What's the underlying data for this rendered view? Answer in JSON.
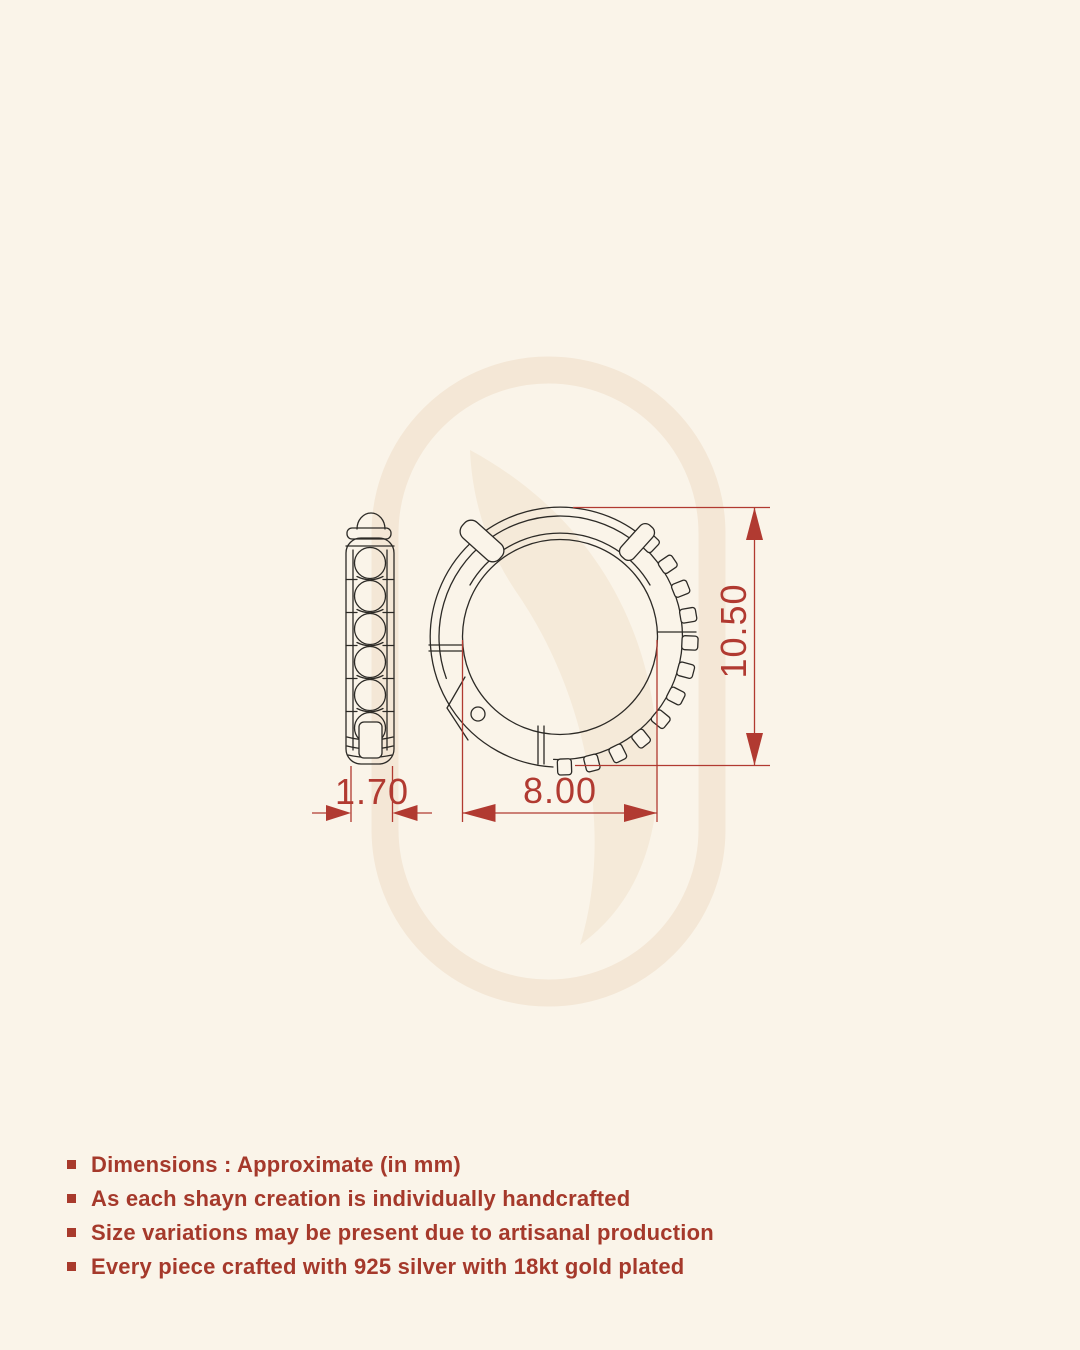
{
  "meta": {
    "description": "Jewellery technical dimension drawing of a huggie hoop earring (side profile and front view) with measurements, over a cream background with brand watermark"
  },
  "colors": {
    "background": "#faf4e9",
    "accent_red": "#b13a31",
    "note_text_red": "#a5392b",
    "drawing_line": "#2c2a26",
    "watermark": "#f4e7d6"
  },
  "dimensions": {
    "side_width": "1.70",
    "inner_diameter": "8.00",
    "outer_height": "10.50"
  },
  "notes": [
    "Dimensions : Approximate (in mm)",
    "As each shayn creation is individually handcrafted",
    "Size variations may be present due to artisanal production",
    "Every piece crafted with 925 silver with 18kt gold plated"
  ]
}
